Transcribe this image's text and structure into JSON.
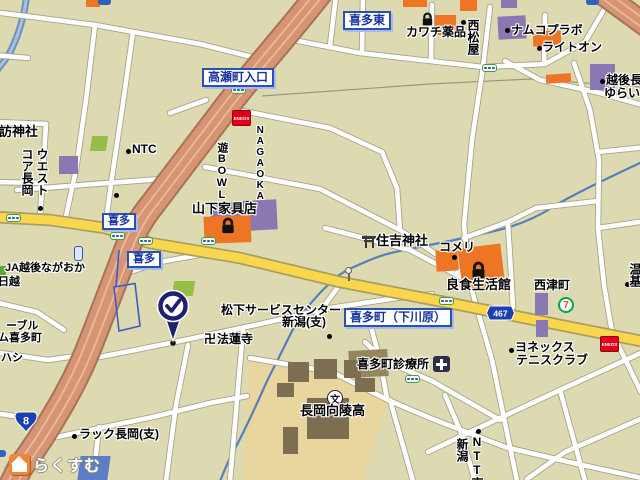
{
  "map_title": "喜多町周辺地図（長岡市）",
  "watermark": {
    "brand": "らくすむ"
  },
  "signs": {
    "kitahigashi": "喜多東",
    "takase_iriguchi": "高瀬町入口",
    "kita_a": "喜多",
    "kita_b": "喜多",
    "shimokawara": "喜多町（下川原）"
  },
  "route_badges": {
    "national_8": "8",
    "prefectural_467": "467"
  },
  "pois": {
    "suwa_jinja": "訪神社",
    "west_core_line1": "ウエスト",
    "west_core_line2": "コア長岡",
    "nagaoka_bowl_line1": "NAGAOKA",
    "nagaoka_bowl_line2": "遊BOWL",
    "ntc": "NTC",
    "yamashita_kagu": "山下家具店",
    "kawachi_yakuhin": "カワチ薬品",
    "nishimatsuya": "西松屋",
    "namco_plabo": "ナムコプラボ",
    "right_on": "ライトオン",
    "yurai_line1": "越後長",
    "yurai_line2": "ゆらい",
    "sumiyoshi_jinja": "住吉神社",
    "komeri": "コメリ",
    "ryoshoku_seikatsukan": "良食生活館",
    "nishizu_cho": "西津町",
    "matsushita_line1": "松下サービスセンター",
    "matsushita_line2": "新潟(支)",
    "manji": "卍",
    "horenji": "法蓮寺",
    "yonex_line1": "ヨネックス",
    "yonex_line2": "テニスクラブ",
    "kitamachi_clinic": "喜多町診療所",
    "koryo_high": "長岡向陵高",
    "ja_line1": "JA越後ながおか",
    "ja_line2": "日越",
    "noble_frag": "ーブル",
    "kitamachi_frag": "ム喜多町",
    "hashi_frag": "ハシ",
    "rack_nagaoka": "ラック長岡(支)",
    "ntt_line1": "NTT東",
    "ntt_line2": "新潟",
    "edge_frag": "温基"
  },
  "icons": {
    "school_glyph": "文",
    "seven_eleven_glyph": "7",
    "eneos_label": "ENEOS"
  }
}
